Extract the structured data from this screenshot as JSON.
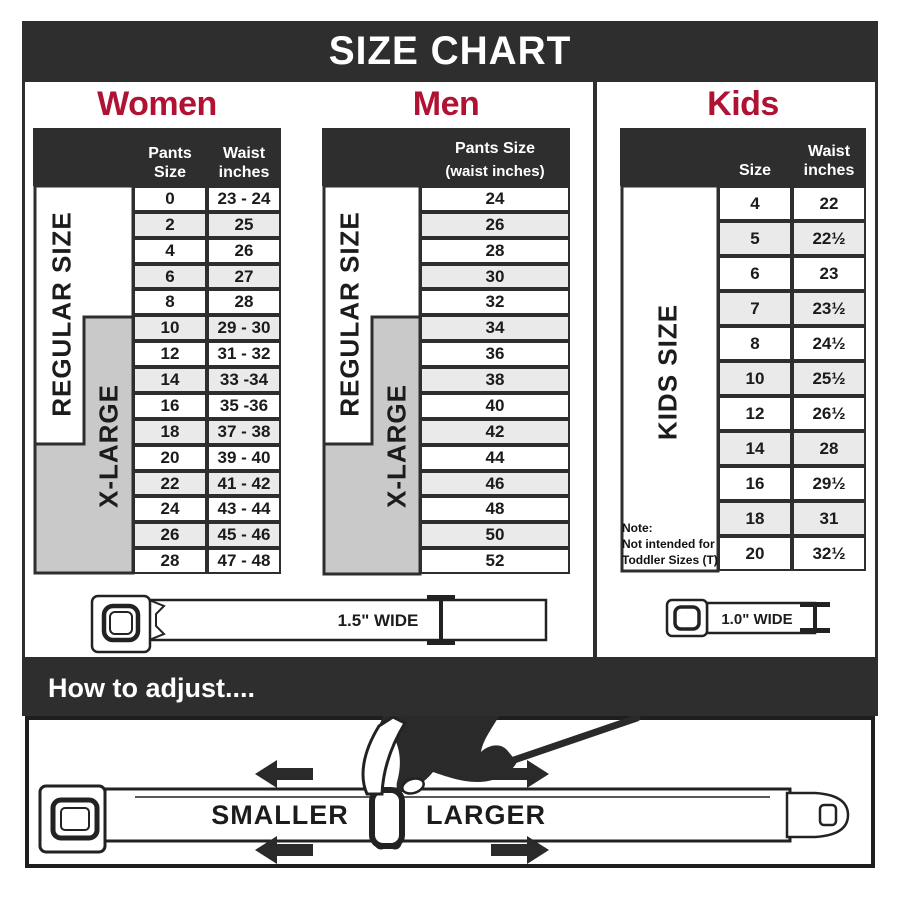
{
  "title": "SIZE CHART",
  "sections": {
    "women": {
      "heading": "Women",
      "pants_header": "Pants Size",
      "waist_header": "Waist inches",
      "regular_label": "REGULAR SIZE",
      "xlarge_label": "X-LARGE",
      "rows": [
        {
          "pants_size": "0",
          "waist_inches": "23 - 24"
        },
        {
          "pants_size": "2",
          "waist_inches": "25"
        },
        {
          "pants_size": "4",
          "waist_inches": "26"
        },
        {
          "pants_size": "6",
          "waist_inches": "27"
        },
        {
          "pants_size": "8",
          "waist_inches": "28"
        },
        {
          "pants_size": "10",
          "waist_inches": "29 - 30"
        },
        {
          "pants_size": "12",
          "waist_inches": "31 - 32"
        },
        {
          "pants_size": "14",
          "waist_inches": "33 -34"
        },
        {
          "pants_size": "16",
          "waist_inches": "35 -36"
        },
        {
          "pants_size": "18",
          "waist_inches": "37 - 38"
        },
        {
          "pants_size": "20",
          "waist_inches": "39 - 40"
        },
        {
          "pants_size": "22",
          "waist_inches": "41 - 42"
        },
        {
          "pants_size": "24",
          "waist_inches": "43 - 44"
        },
        {
          "pants_size": "26",
          "waist_inches": "45 - 46"
        },
        {
          "pants_size": "28",
          "waist_inches": "47 - 48"
        }
      ]
    },
    "men": {
      "heading": "Men",
      "header_line1": "Pants Size",
      "header_line2": "(waist inches)",
      "regular_label": "REGULAR SIZE",
      "xlarge_label": "X-LARGE",
      "rows": [
        "24",
        "26",
        "28",
        "30",
        "32",
        "34",
        "36",
        "38",
        "40",
        "42",
        "44",
        "46",
        "48",
        "50",
        "52"
      ]
    },
    "kids": {
      "heading": "Kids",
      "size_header": "Size",
      "waist_header": "Waist inches",
      "kids_label": "KIDS SIZE",
      "note_title": "Note:",
      "note_line1": "Not intended for",
      "note_line2": "Toddler Sizes (T)",
      "rows": [
        {
          "size": "4",
          "waist_inches": "22"
        },
        {
          "size": "5",
          "waist_inches": "22½"
        },
        {
          "size": "6",
          "waist_inches": "23"
        },
        {
          "size": "7",
          "waist_inches": "23½"
        },
        {
          "size": "8",
          "waist_inches": "24½"
        },
        {
          "size": "10",
          "waist_inches": "25½"
        },
        {
          "size": "12",
          "waist_inches": "26½"
        },
        {
          "size": "14",
          "waist_inches": "28"
        },
        {
          "size": "16",
          "waist_inches": "29½"
        },
        {
          "size": "18",
          "waist_inches": "31"
        },
        {
          "size": "20",
          "waist_inches": "32½"
        }
      ]
    }
  },
  "belts": {
    "adult_width_label": "1.5\" WIDE",
    "kids_width_label": "1.0\" WIDE"
  },
  "how_to_adjust": {
    "heading": "How to adjust....",
    "smaller_label": "SMALLER",
    "larger_label": "LARGER"
  },
  "colors": {
    "dark": "#2e2e2e",
    "accent_red": "#b01233",
    "gray_block": "#c9c9c9",
    "alt_row": "#eaeaea"
  },
  "chart_data": [
    {
      "type": "table",
      "title": "Women",
      "columns": [
        "Pants Size",
        "Waist inches"
      ],
      "rows": [
        [
          "0",
          "23 - 24"
        ],
        [
          "2",
          "25"
        ],
        [
          "4",
          "26"
        ],
        [
          "6",
          "27"
        ],
        [
          "8",
          "28"
        ],
        [
          "10",
          "29 - 30"
        ],
        [
          "12",
          "31 - 32"
        ],
        [
          "14",
          "33 -34"
        ],
        [
          "16",
          "35 -36"
        ],
        [
          "18",
          "37 - 38"
        ],
        [
          "20",
          "39 - 40"
        ],
        [
          "22",
          "41 - 42"
        ],
        [
          "24",
          "43 - 44"
        ],
        [
          "26",
          "45 - 46"
        ],
        [
          "28",
          "47 - 48"
        ]
      ],
      "groups": {
        "REGULAR SIZE": "pants 0-18",
        "X-LARGE": "pants 10-28"
      },
      "belt_width": "1.5\" WIDE"
    },
    {
      "type": "table",
      "title": "Men",
      "columns": [
        "Pants Size (waist inches)"
      ],
      "rows": [
        [
          "24"
        ],
        [
          "26"
        ],
        [
          "28"
        ],
        [
          "30"
        ],
        [
          "32"
        ],
        [
          "34"
        ],
        [
          "36"
        ],
        [
          "38"
        ],
        [
          "40"
        ],
        [
          "42"
        ],
        [
          "44"
        ],
        [
          "46"
        ],
        [
          "48"
        ],
        [
          "50"
        ],
        [
          "52"
        ]
      ],
      "groups": {
        "REGULAR SIZE": "24-42",
        "X-LARGE": "34-52"
      },
      "belt_width": "1.5\" WIDE"
    },
    {
      "type": "table",
      "title": "Kids",
      "columns": [
        "Size",
        "Waist inches"
      ],
      "rows": [
        [
          "4",
          "22"
        ],
        [
          "5",
          "22½"
        ],
        [
          "6",
          "23"
        ],
        [
          "7",
          "23½"
        ],
        [
          "8",
          "24½"
        ],
        [
          "10",
          "25½"
        ],
        [
          "12",
          "26½"
        ],
        [
          "14",
          "28"
        ],
        [
          "16",
          "29½"
        ],
        [
          "18",
          "31"
        ],
        [
          "20",
          "32½"
        ]
      ],
      "groups": {
        "KIDS SIZE": "4-20"
      },
      "note": "Note: Not intended for Toddler Sizes (T)",
      "belt_width": "1.0\" WIDE"
    }
  ]
}
